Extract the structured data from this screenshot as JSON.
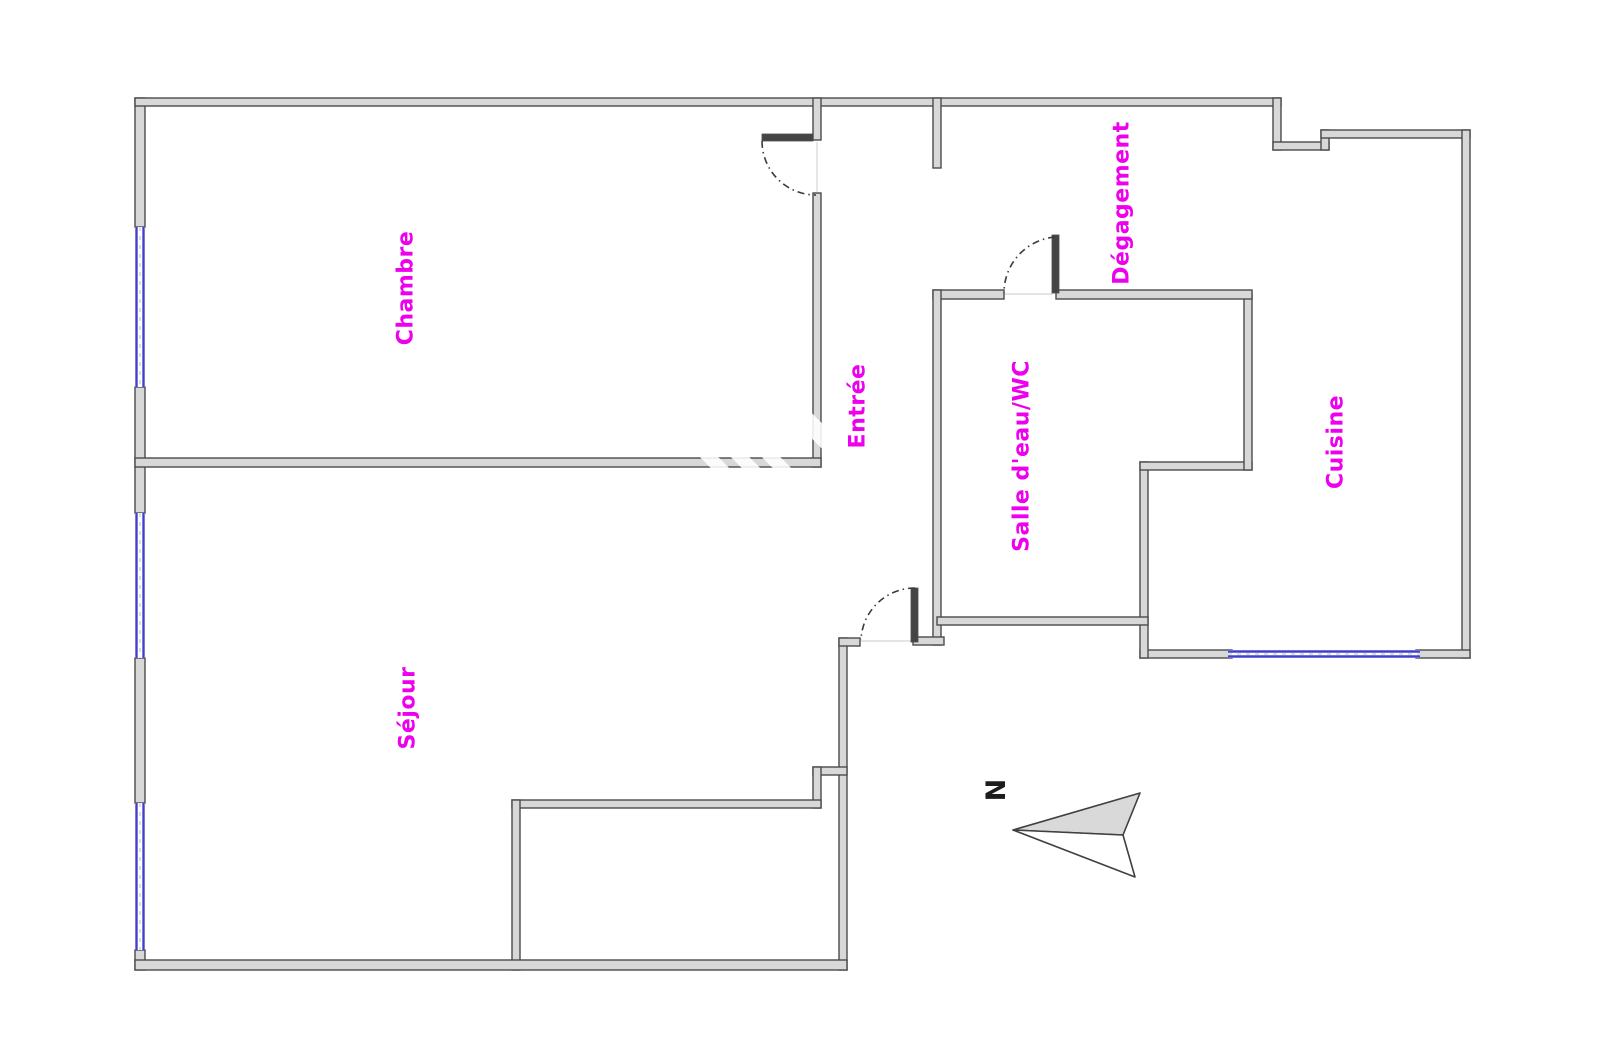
{
  "meta": {
    "width": 1600,
    "height": 1064,
    "background": "#ffffff"
  },
  "colors": {
    "wall_fill": "#d8d8d8",
    "wall_stroke": "#4b4b4b",
    "window_blue": "#4040cf",
    "window_center_dash": "#bdbdbd",
    "door_leaf": "#454545",
    "arc_stroke": "#3a3a3a",
    "threshold": "#dcdcdc",
    "label_magenta": "#ee00ee",
    "north_fill": "#d9d9d9",
    "north_stroke": "#404040",
    "north_text": "#1c1c1c",
    "watermark": "rgba(255,255,255,0.88)"
  },
  "rooms": [
    {
      "label": "Chambre",
      "cx": 406,
      "cy": 288,
      "font_px": 22
    },
    {
      "label": "Entrée",
      "cx": 858,
      "cy": 406,
      "font_px": 22
    },
    {
      "label": "Dégagement",
      "cx": 1122,
      "cy": 203,
      "font_px": 22
    },
    {
      "label": "Salle d'eau/WC",
      "cx": 1022,
      "cy": 456,
      "font_px": 22
    },
    {
      "label": "Cuisine",
      "cx": 1336,
      "cy": 442,
      "font_px": 22
    },
    {
      "label": "Séjour",
      "cx": 408,
      "cy": 708,
      "font_px": 22
    }
  ],
  "north": {
    "label": "N",
    "cx": 994,
    "cy": 790,
    "font_px": 27,
    "upper_triangle": "1013,830 1140,793 1123,835",
    "lower_triangle": "1013,830 1123,835 1135,877"
  },
  "walls": [
    [
      135,
      98,
      10,
      129
    ],
    [
      135,
      387,
      10,
      126
    ],
    [
      135,
      658,
      10,
      145
    ],
    [
      135,
      950,
      10,
      20
    ],
    [
      135,
      98,
      1146,
      8
    ],
    [
      1273,
      98,
      8,
      52
    ],
    [
      1273,
      142,
      56,
      8
    ],
    [
      1321,
      130,
      8,
      20
    ],
    [
      1321,
      130,
      149,
      8
    ],
    [
      1462,
      130,
      8,
      528
    ],
    [
      1140,
      650,
      92,
      8
    ],
    [
      1416,
      650,
      54,
      8
    ],
    [
      1140,
      462,
      8,
      196
    ],
    [
      1140,
      462,
      112,
      8
    ],
    [
      1244,
      293,
      8,
      177
    ],
    [
      933,
      290,
      71,
      9
    ],
    [
      1056,
      290,
      196,
      9
    ],
    [
      933,
      290,
      8,
      355
    ],
    [
      937,
      617,
      211,
      8
    ],
    [
      913,
      637,
      31,
      8
    ],
    [
      933,
      98,
      8,
      70
    ],
    [
      813,
      98,
      8,
      42
    ],
    [
      813,
      193,
      8,
      274
    ],
    [
      135,
      458,
      686,
      9
    ],
    [
      839,
      638,
      8,
      332
    ],
    [
      839,
      638,
      21,
      8
    ],
    [
      813,
      767,
      34,
      8
    ],
    [
      813,
      767,
      8,
      41
    ],
    [
      512,
      800,
      309,
      8
    ],
    [
      512,
      800,
      8,
      170
    ],
    [
      135,
      960,
      712,
      10
    ]
  ],
  "windows": [
    {
      "o": "v",
      "x": 135,
      "y": 227,
      "w": 10,
      "h": 160
    },
    {
      "o": "v",
      "x": 135,
      "y": 513,
      "w": 10,
      "h": 145
    },
    {
      "o": "v",
      "x": 135,
      "y": 803,
      "w": 10,
      "h": 147
    },
    {
      "o": "h",
      "x": 1228,
      "y": 650,
      "w": 192,
      "h": 8
    }
  ],
  "door_leaves": [
    [
      762,
      134,
      51,
      7
    ],
    [
      911,
      588,
      7,
      54
    ],
    [
      1052,
      235,
      7,
      58
    ]
  ],
  "door_arcs": [
    "M 762 141 A 54 54 0 0 0 816 195",
    "M 915 588 A 54 54 0 0 0 861 640",
    "M 1055 237 A 56 56 0 0 0 1004 293"
  ],
  "thresholds": [
    [
      817,
      142,
      817,
      192
    ],
    [
      861,
      641,
      912,
      641
    ],
    [
      1005,
      294,
      1053,
      294
    ]
  ],
  "watermark_stripes": [
    {
      "cx": 712,
      "cy": 460,
      "w": 13,
      "h": 88
    },
    {
      "cx": 746,
      "cy": 463,
      "w": 13,
      "h": 88
    },
    {
      "cx": 780,
      "cy": 466,
      "w": 13,
      "h": 88
    },
    {
      "cx": 817,
      "cy": 431,
      "w": 18,
      "h": 72
    }
  ]
}
